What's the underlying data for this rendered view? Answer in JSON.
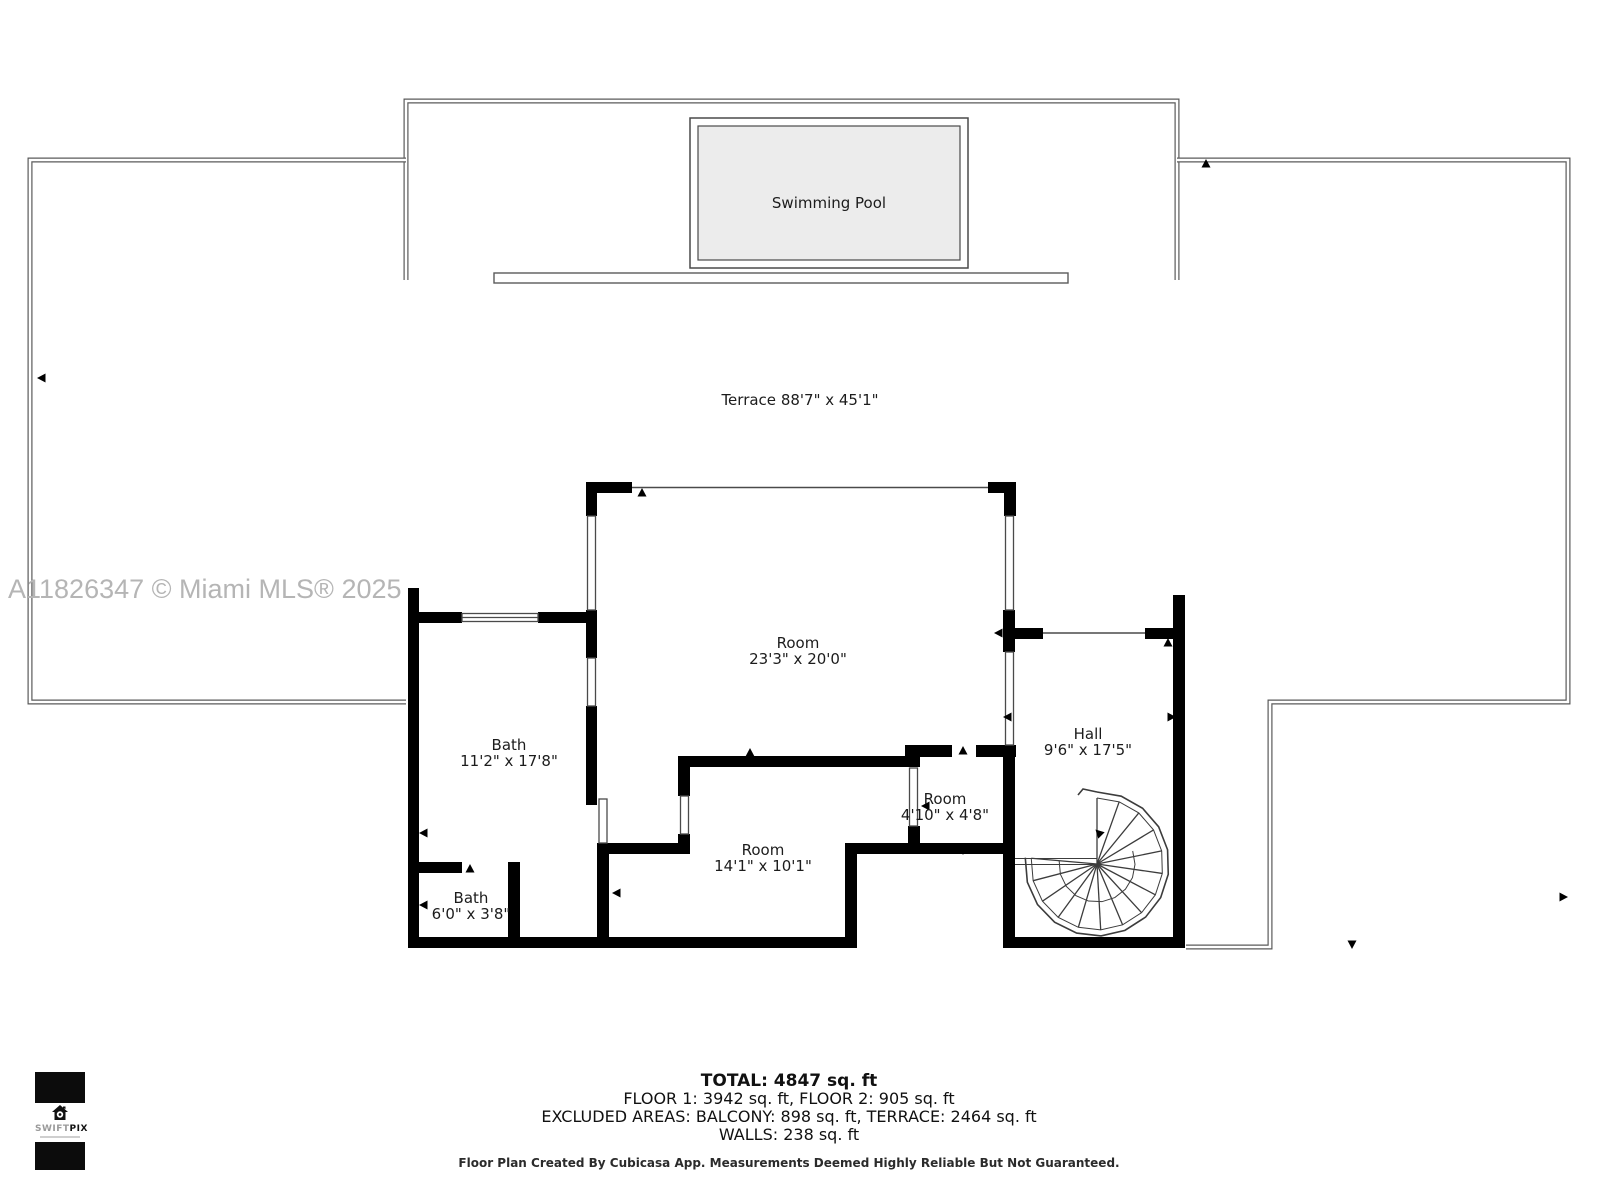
{
  "watermark": "A11826347 © Miami MLS® 2025",
  "pool": {
    "label": "Swimming Pool"
  },
  "terrace": {
    "label": "Terrace",
    "dims": "88'7\" x 45'1\""
  },
  "rooms": [
    {
      "name": "Room",
      "dims": "23'3\" x 20'0\"",
      "cx": 798,
      "cy": 651
    },
    {
      "name": "Bath",
      "dims": "11'2\" x 17'8\"",
      "cx": 509,
      "cy": 753
    },
    {
      "name": "Bath",
      "dims": "6'0\" x 3'8\"",
      "cx": 471,
      "cy": 906
    },
    {
      "name": "Room",
      "dims": "14'1\" x 10'1\"",
      "cx": 763,
      "cy": 858
    },
    {
      "name": "Room",
      "dims": "4'10\" x 4'8\"",
      "cx": 945,
      "cy": 807
    },
    {
      "name": "Hall",
      "dims": "9'6\" x 17'5\"",
      "cx": 1088,
      "cy": 742
    }
  ],
  "summary": {
    "total": "TOTAL: 4847 sq. ft",
    "floors": "FLOOR 1: 3942 sq. ft, FLOOR 2: 905 sq. ft",
    "excluded": "EXCLUDED AREAS: BALCONY: 898 sq. ft, TERRACE: 2464 sq. ft",
    "walls": "WALLS: 238 sq. ft",
    "disclaimer": "Floor Plan Created By Cubicasa App. Measurements Deemed Highly Reliable But Not Guaranteed."
  },
  "logo": {
    "brand_light": "SWIFT",
    "brand_bold": "PIX"
  },
  "colors": {
    "wall": "#000000",
    "thin_line": "#4a4a4a",
    "terrace_line": "#5a5a5a",
    "pool_fill": "#ececec",
    "watermark": "#b5b5b5"
  }
}
